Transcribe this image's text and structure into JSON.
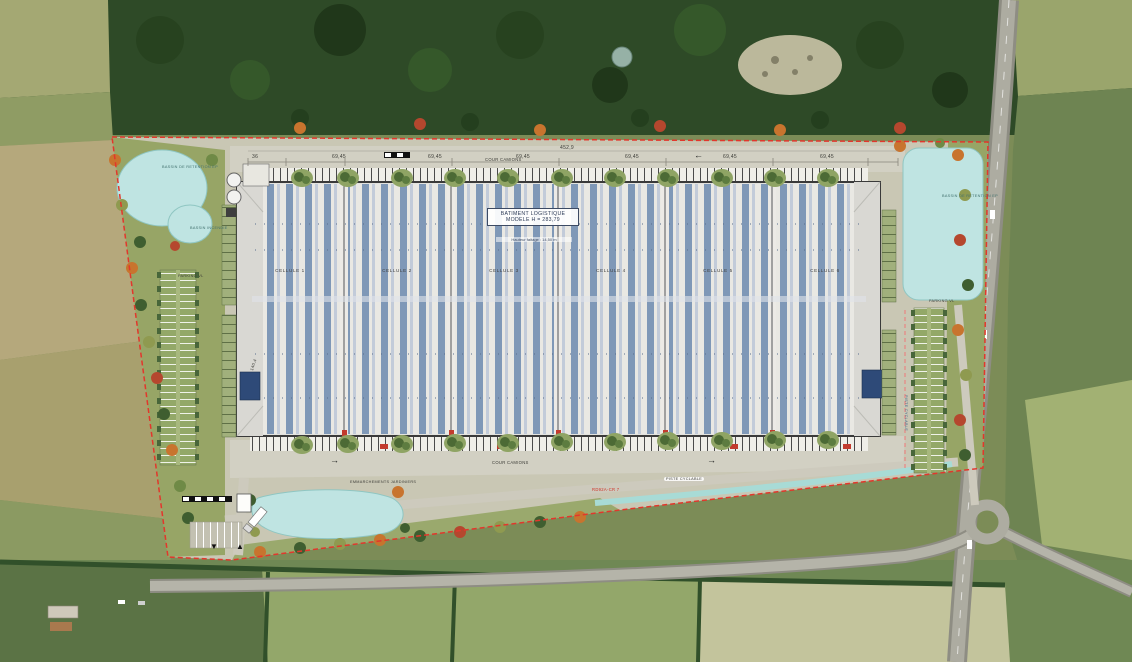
{
  "plan": {
    "dims": {
      "left_offset": "36",
      "bay": "69,45",
      "total": "452,9",
      "building_depth": "140,4"
    },
    "cour_camions_top": "COUR CAMIONS",
    "cour_camions_bottom": "COUR CAMIONS",
    "building": {
      "title_line1": "BATIMENT LOGISTIQUE",
      "title_line2": "MODELE H = 283,79",
      "subtitle": "Hauteur faitage : 14,50 m",
      "cells": [
        "CELLULE 1",
        "CELLULE 2",
        "CELLULE 3",
        "CELLULE 4",
        "CELLULE 5",
        "CELLULE 6"
      ]
    },
    "ponds": {
      "northwest": "BASSIN DE RETENTION EP",
      "northwest_small": "BASSIN INCENDIE",
      "east": "BASSIN DE RETENTION EP"
    },
    "parking": {
      "west": "PARKING VL",
      "east": "PARKING VL"
    },
    "south": {
      "steps": "EMMARCHEMENTS JARDINIERS",
      "road_ref": "RD92A-CR 7",
      "cycle_path": "PISTE CYCLABLE"
    },
    "markers": {
      "down_triangle": "▼",
      "up_triangle": "▲",
      "arrow_left": "←",
      "arrow_right": "→"
    }
  },
  "colors": {
    "boundary_red": "#e2372c",
    "water": "#bfe4e2",
    "roof_stripe_blue": "#7f98b7",
    "forest_green": "#2e4a27",
    "paving": "#c9c7b4"
  }
}
